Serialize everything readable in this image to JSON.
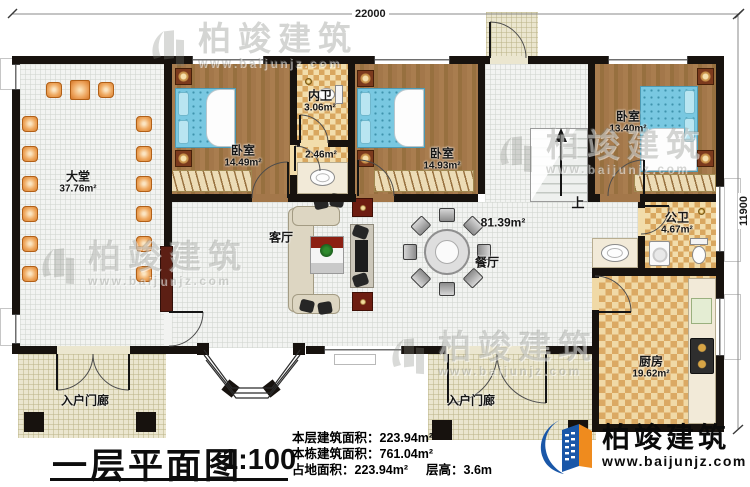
{
  "dims": {
    "top": "22000",
    "right": "11900"
  },
  "rooms": {
    "lobby": {
      "name": "大堂",
      "area": "37.76m²"
    },
    "bedroom1": {
      "name": "卧室",
      "area": "14.49m²"
    },
    "inner_bath": {
      "name": "内卫",
      "area": "3.06m²"
    },
    "corridor": {
      "area": "2.46m²"
    },
    "bedroom2": {
      "name": "卧室",
      "area": "14.93m²"
    },
    "bedroom3": {
      "name": "卧室",
      "area": "13.40m²"
    },
    "public_bath": {
      "name": "公卫",
      "area": "4.67m²"
    },
    "open_area": {
      "area": "81.39m²"
    },
    "living": {
      "name": "客厅"
    },
    "dining": {
      "name": "餐厅"
    },
    "kitchen": {
      "name": "厨房",
      "area": "19.62m²"
    },
    "porch_left": {
      "name": "入户门廊"
    },
    "porch_right": {
      "name": "入户门廊"
    },
    "stairs": {
      "label": "上"
    }
  },
  "title_block": {
    "title": "一层平面图",
    "scale": "1:100",
    "line1": "本层建筑面积：223.94m²",
    "line2": "本栋建筑面积：761.04m²",
    "line3_left": "占地面积：223.94m²",
    "line3_right": "层高：3.6m"
  },
  "branding": {
    "name": "柏竣建筑",
    "url": "www.baijunjz.com"
  },
  "watermark": {
    "name": "柏竣建筑",
    "url": "www.baijunjz.com"
  },
  "colors": {
    "wall": "#17120e",
    "wood": "#9d7343",
    "checker": "#d8a55e",
    "bed": "#76c6df",
    "porch": "#ebe6cf",
    "logo_blue": "#1a57a8",
    "logo_orange": "#ef8b1e"
  }
}
